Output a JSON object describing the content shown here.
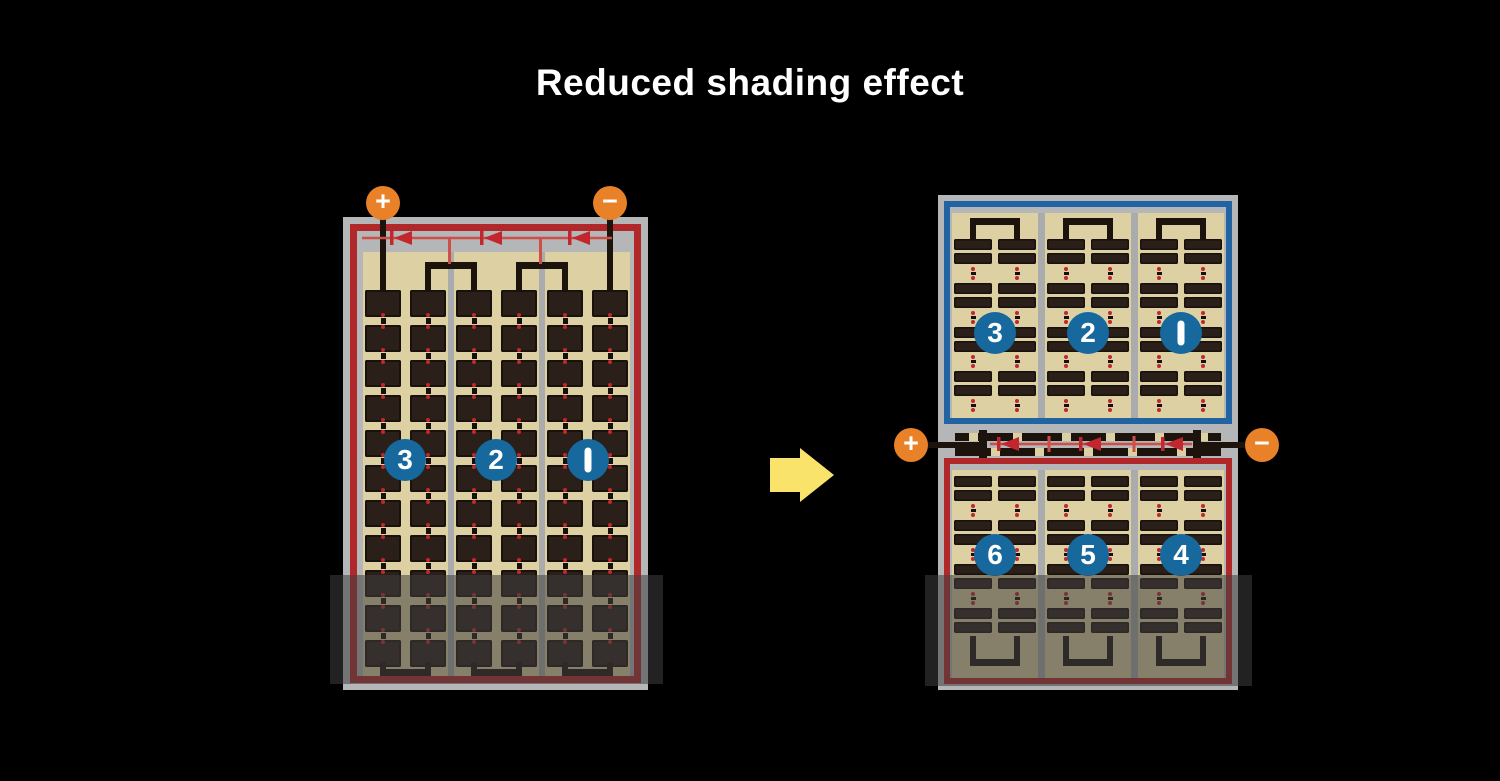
{
  "title": "Reduced shading effect",
  "diagram": {
    "left_panel": {
      "terminals": {
        "positive": "+",
        "negative": "−"
      },
      "section_labels": [
        "3",
        "2",
        "1"
      ]
    },
    "arrow": {
      "direction": "right"
    },
    "right_panel": {
      "terminals": {
        "positive": "+",
        "negative": "−"
      },
      "top_section_labels": [
        "3",
        "2",
        "1"
      ],
      "bottom_section_labels": [
        "6",
        "5",
        "4"
      ]
    }
  },
  "colors": {
    "background": "#000000",
    "title_text": "#ffffff",
    "panel_frame_gray": "#b4b6b8",
    "column_divider_gray": "#a9abac",
    "cell_background_tan": "#ddd1a3",
    "cell_dark_brown": "#2a2019",
    "cell_outline": "#19110b",
    "busbar_black": "#1c130c",
    "string_border_red": "#b1282b",
    "diode_wire_red": "#cd4f48",
    "diode_symbol_red": "#c1272d",
    "string_border_blue": "#2263a2",
    "terminal_orange": "#e98128",
    "number_circle_blue": "#16689d",
    "number_text_white": "#ffffff",
    "arrow_yellow": "#fae36a",
    "shade_overlay": "rgba(62,62,62,0.55)"
  }
}
